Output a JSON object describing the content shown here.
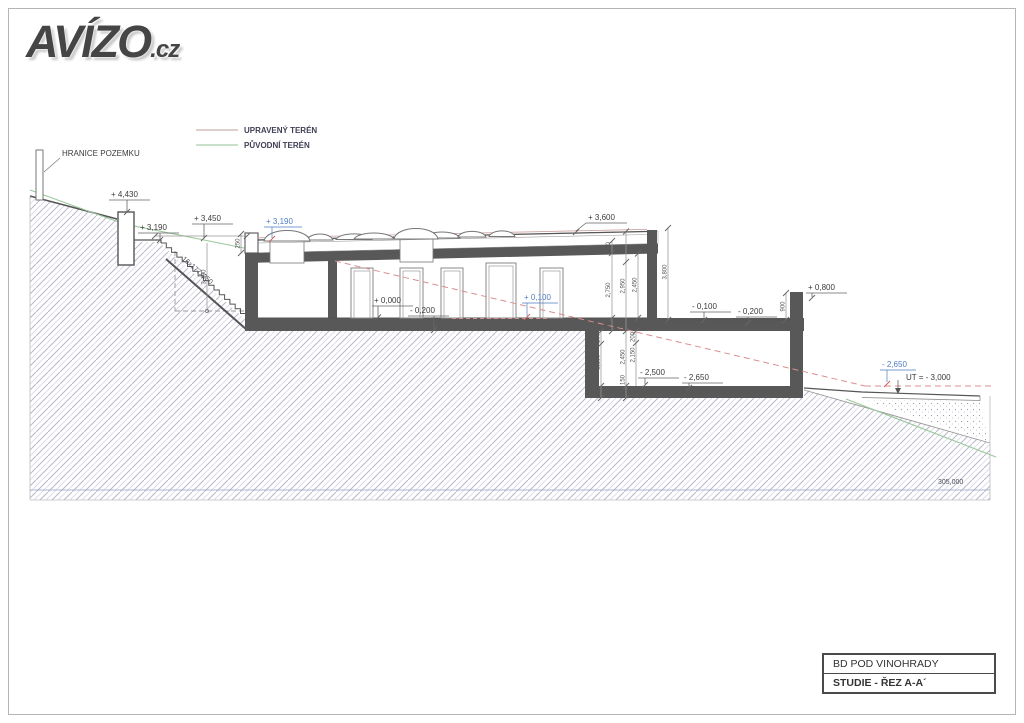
{
  "logo": {
    "text": "AVÍZO",
    "suffix": ".cz"
  },
  "legend": {
    "upraveny": "UPRAVENÝ TERÉN",
    "puvodni": "PŮVODNÍ TERÉN"
  },
  "site": {
    "hranice": "HRANICE POZEMKU",
    "stair_spec": "16x177x250",
    "datum": "305,000",
    "ut": "UT = - 3,000"
  },
  "elevations": {
    "e4430": "+ 4,430",
    "e3190_street": "+ 3,190",
    "e3450": "+ 3,450",
    "e3190_roof": "+ 3,190",
    "e3600": "+ 3,600",
    "e0000": "+ 0,000",
    "em0200_floor": "- 0,200",
    "e0100": "+ 0,100",
    "em0100": "- 0,100",
    "em0200_terrace": "- 0,200",
    "e0800": "+ 0,800",
    "em2500": "- 2,500",
    "em2650": "- 2,650",
    "em2650_terrain": "- 2,650"
  },
  "dimensions": {
    "roof_250": "250",
    "edge_250": "250",
    "h2750": "2,750",
    "h2950": "2,950",
    "h2450": "2,450",
    "base_200": "200",
    "total_3800": "3,800",
    "parapet_900": "900",
    "low_200": "200",
    "low_2250": "2,250",
    "low_2450": "2,450",
    "low_2150": "2,150",
    "low_150": "150",
    "low_100": "100",
    "stair_3190": "3,190",
    "top_200": "200"
  },
  "titleblock": {
    "project": "BD POD VINOHRADY",
    "drawing": "STUDIE - ŘEZ A-A´"
  },
  "colors": {
    "blue_label": "#4f7dc0",
    "green_terrain": "#9cc89c",
    "red_dashed": "#d98f8f",
    "cut_wall": "#585858"
  }
}
